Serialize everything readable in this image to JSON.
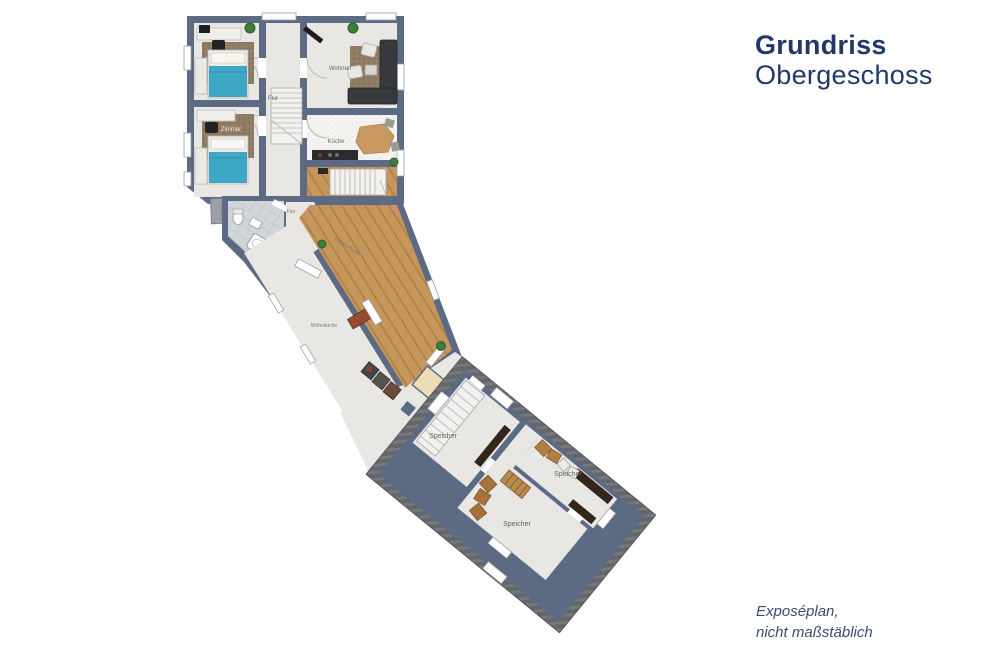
{
  "title": {
    "line1": "Grundriss",
    "line2": "Obergeschoss"
  },
  "footnote": {
    "line1": "Exposéplan,",
    "line2": "nicht maßstäblich"
  },
  "colors": {
    "accent_navy": "#21386b",
    "footnote_navy": "#3c4c72",
    "wall": "#5c6a84",
    "floor_light": "#e8e7e4",
    "floor_speckle": "#f4f3f0",
    "wood": "#c6975c",
    "tile": "#d2d6d9",
    "roof_hatch": "#63666a",
    "carpet": "#8d7b64",
    "bed_blue": "#3fa8c7",
    "sofa_dark": "#38393c",
    "cabinet_brown": "#33261a",
    "dresser_red": "#9a4a2c",
    "plant_green": "#3f7d3a"
  },
  "plan": {
    "rooms": [
      {
        "id": "bedroom-1",
        "label": "Zimmer"
      },
      {
        "id": "bedroom-2",
        "label": "Zimmer"
      },
      {
        "id": "hall-upper",
        "label": "Flur"
      },
      {
        "id": "living-room",
        "label": "Wohnen"
      },
      {
        "id": "kitchen",
        "label": "Küche"
      },
      {
        "id": "hall-mid",
        "label": "Flur"
      },
      {
        "id": "stair-hall",
        "label": "Treppenhaus"
      },
      {
        "id": "open-kitchen",
        "label": "Wohnküche"
      },
      {
        "id": "attic-storage-1",
        "label": "Speicher"
      },
      {
        "id": "attic-storage-2",
        "label": "Speicher"
      },
      {
        "id": "attic-storage-3",
        "label": "Speicher"
      }
    ]
  }
}
